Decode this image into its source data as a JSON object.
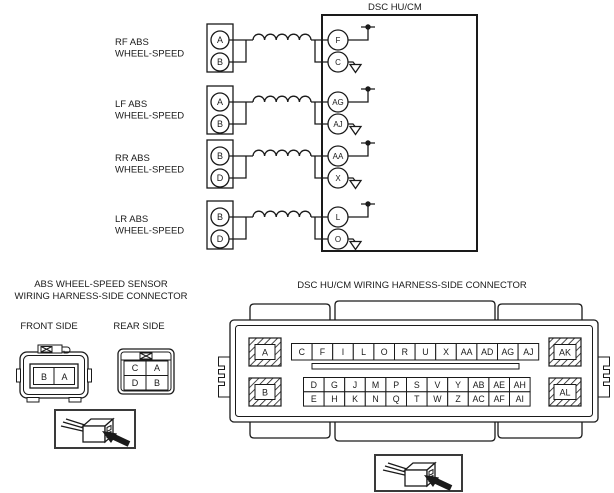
{
  "diagram": {
    "title": "DSC HU/CM",
    "rows": [
      {
        "label1": "RF ABS",
        "label2": "WHEEL-SPEED",
        "sensor_pins": [
          "A",
          "B"
        ],
        "dsc_pins": [
          "F",
          "C"
        ]
      },
      {
        "label1": "LF ABS",
        "label2": "WHEEL-SPEED",
        "sensor_pins": [
          "A",
          "B"
        ],
        "dsc_pins": [
          "AG",
          "AJ"
        ]
      },
      {
        "label1": "RR ABS",
        "label2": "WHEEL-SPEED",
        "sensor_pins": [
          "B",
          "D"
        ],
        "dsc_pins": [
          "AA",
          "X"
        ]
      },
      {
        "label1": "LR ABS",
        "label2": "WHEEL-SPEED",
        "sensor_pins": [
          "B",
          "D"
        ],
        "dsc_pins": [
          "L",
          "O"
        ]
      }
    ]
  },
  "sensor_connector": {
    "title1": "ABS WHEEL-SPEED SENSOR",
    "title2": "WIRING HARNESS-SIDE CONNECTOR",
    "front_label": "FRONT SIDE",
    "rear_label": "REAR SIDE",
    "front_pins": [
      "B",
      "A"
    ],
    "rear_pins": [
      [
        "C",
        "A"
      ],
      [
        "D",
        "B"
      ]
    ]
  },
  "dsc_connector": {
    "title": "DSC HU/CM WIRING HARNESS-SIDE CONNECTOR",
    "corner_pins": [
      "A",
      "B",
      "AK",
      "AL"
    ],
    "top_row": [
      "C",
      "F",
      "I",
      "L",
      "O",
      "R",
      "U",
      "X",
      "AA",
      "AD",
      "AG",
      "AJ"
    ],
    "mid_row": [
      "D",
      "G",
      "J",
      "M",
      "P",
      "S",
      "V",
      "Y",
      "AB",
      "AE",
      "AH"
    ],
    "bottom_row": [
      "E",
      "H",
      "K",
      "N",
      "Q",
      "T",
      "W",
      "Z",
      "AC",
      "AF",
      "AI"
    ]
  },
  "colors": {
    "line": "#1a1a1a",
    "background": "#ffffff"
  }
}
